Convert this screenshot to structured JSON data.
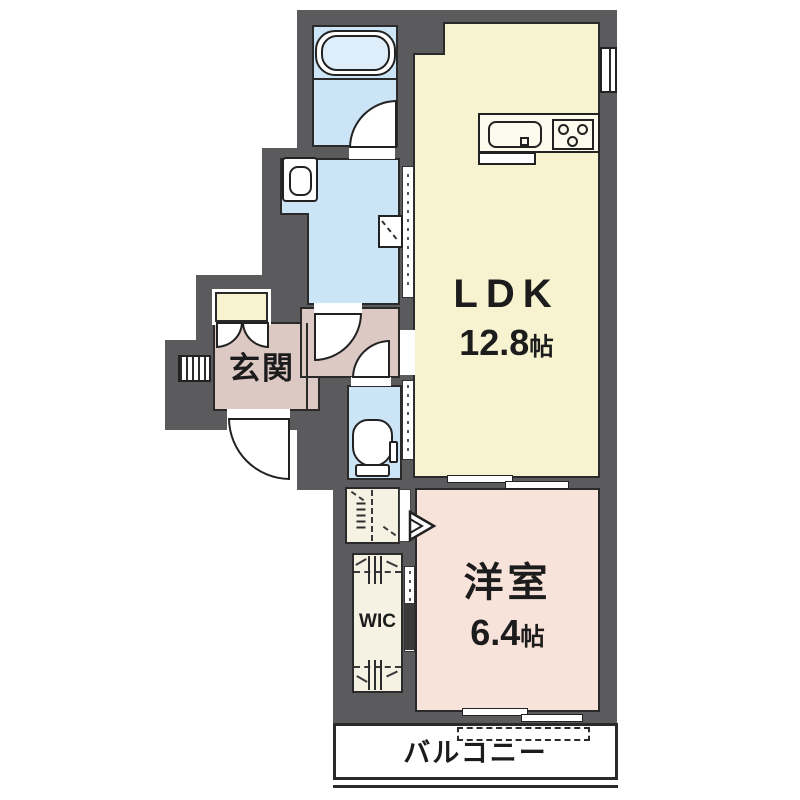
{
  "plan": {
    "rooms": {
      "ldk": {
        "label": "LDK",
        "area_value": "12.8",
        "area_unit": "帖"
      },
      "western": {
        "label": "洋室",
        "area_value": "6.4",
        "area_unit": "帖"
      },
      "entrance": {
        "label": "玄関"
      },
      "wic": {
        "label": "WIC"
      },
      "balcony": {
        "label": "バルコニー"
      }
    },
    "colors": {
      "wall": "#5b5b5d",
      "ldk_floor": "#f7f2d0",
      "western_floor": "#f8e3da",
      "entrance_floor": "#ddc9c4",
      "wet_area_floor": "#cbe4f6",
      "closet_floor": "#f5f2e3",
      "outline": "#222222"
    }
  }
}
